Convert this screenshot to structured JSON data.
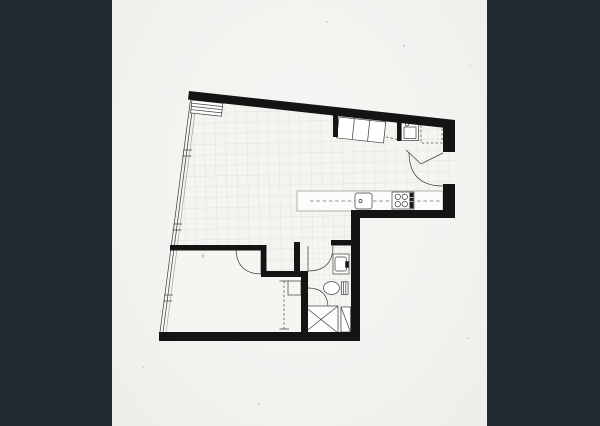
{
  "scene": {
    "kind": "architectural-floor-plan",
    "style": "black-and-white line drawing on light paper, pillarboxed by dark side bars",
    "rooms": [
      {
        "name": "living-dining-area",
        "floor": "tile-grid"
      },
      {
        "name": "kitchen",
        "floor": "tile-grid"
      },
      {
        "name": "entry",
        "floor": "tile-grid"
      },
      {
        "name": "bedroom",
        "floor": "plain"
      },
      {
        "name": "bathroom",
        "floor": "small-tile-grid"
      },
      {
        "name": "hall-nook",
        "floor": "tile-grid"
      }
    ],
    "symbols": [
      {
        "name": "window-wall",
        "room": "living-dining-area"
      },
      {
        "name": "blind-box",
        "room": "living-dining-area"
      },
      {
        "name": "entry-wardrobe",
        "room": "entry"
      },
      {
        "name": "washer",
        "room": "entry"
      },
      {
        "name": "fridge-space-dashed",
        "room": "entry"
      },
      {
        "name": "entry-door-swing",
        "room": "entry"
      },
      {
        "name": "kitchen-counter",
        "room": "kitchen"
      },
      {
        "name": "kitchen-sink",
        "room": "kitchen"
      },
      {
        "name": "cooktop",
        "room": "kitchen"
      },
      {
        "name": "bedroom-door-swing",
        "room": "bedroom"
      },
      {
        "name": "sliding-wardrobe-dashed",
        "room": "bedroom"
      },
      {
        "name": "shelf-box",
        "room": "bedroom"
      },
      {
        "name": "bathroom-door-swing",
        "room": "bathroom"
      },
      {
        "name": "wash-basin",
        "room": "bathroom"
      },
      {
        "name": "toilet",
        "room": "bathroom"
      },
      {
        "name": "shower-door-swing",
        "room": "bathroom"
      },
      {
        "name": "shower-tray",
        "room": "bathroom"
      },
      {
        "name": "bathroom-cabinet",
        "room": "bathroom"
      }
    ]
  },
  "colors": {
    "letterbox": "#222933",
    "paper": "#f3f2ef",
    "paper2": "#f6f5f2",
    "floor": "#f5f4f1",
    "wall": "#141414",
    "line": "#3a3a3a",
    "grid": "#dbdad6",
    "counterline": "#a8a8a2"
  }
}
